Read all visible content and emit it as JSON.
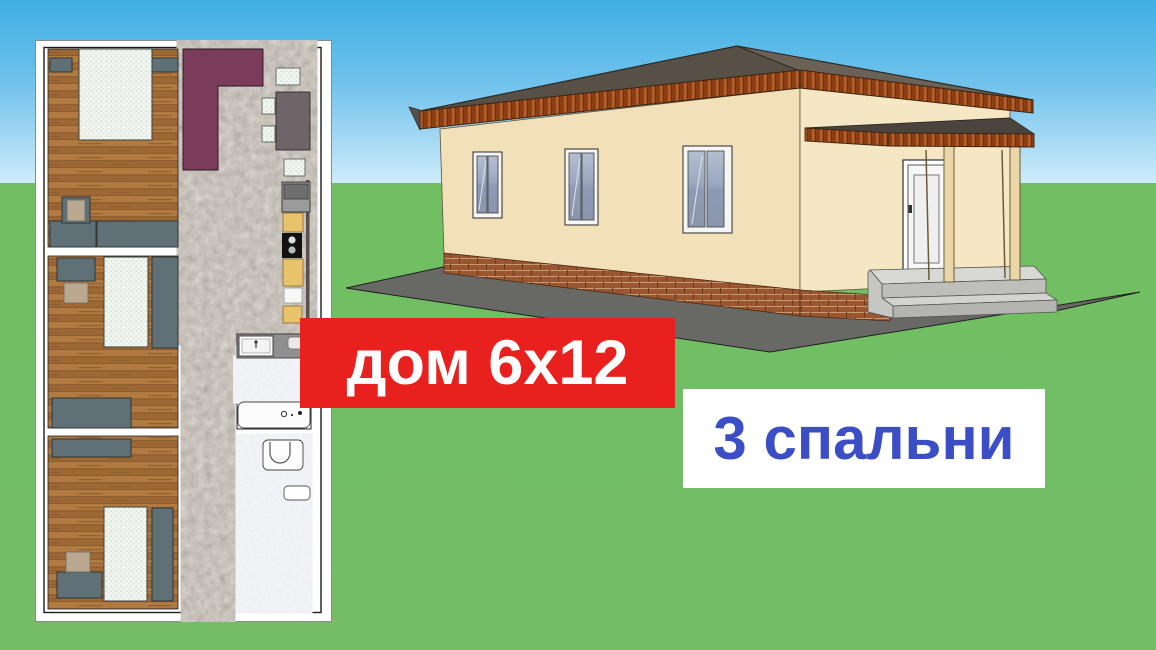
{
  "banners": {
    "size": {
      "label": "дом 6х12",
      "bg": "#e8201e",
      "fg": "#ffffff"
    },
    "bedrooms": {
      "label": "3 спальни",
      "bg": "#ffffff",
      "fg": "#3b4ec5"
    }
  },
  "scene": {
    "sky_top": "#3fafe3",
    "sky_horizon": "#cfecfa",
    "grass": "#74bd66",
    "house": {
      "wall_front": "#f2e0b8",
      "wall_end": "#f6e7c4",
      "roof": "#575046",
      "roof_trim_wood": "#a04c1e",
      "brick_base": "#9a5630",
      "window_glass": "#93a0b8",
      "door": "#f7f7f7",
      "porch_post": "#ead6a8",
      "steps_concrete": "#d3d3d0",
      "pavement": "#686864"
    },
    "floor_plan": {
      "frame": "#ffffff",
      "wood_floor": "#a9713c",
      "stone_floor": "#8b8379",
      "tile_floor": "#dde1e8",
      "accent_purple": "#7b3c59",
      "furniture_gray": "#5f7077",
      "bed_white": "#f1f5f0",
      "cabinet_yellow": "#e9c36c",
      "stove_black": "#121212"
    }
  }
}
